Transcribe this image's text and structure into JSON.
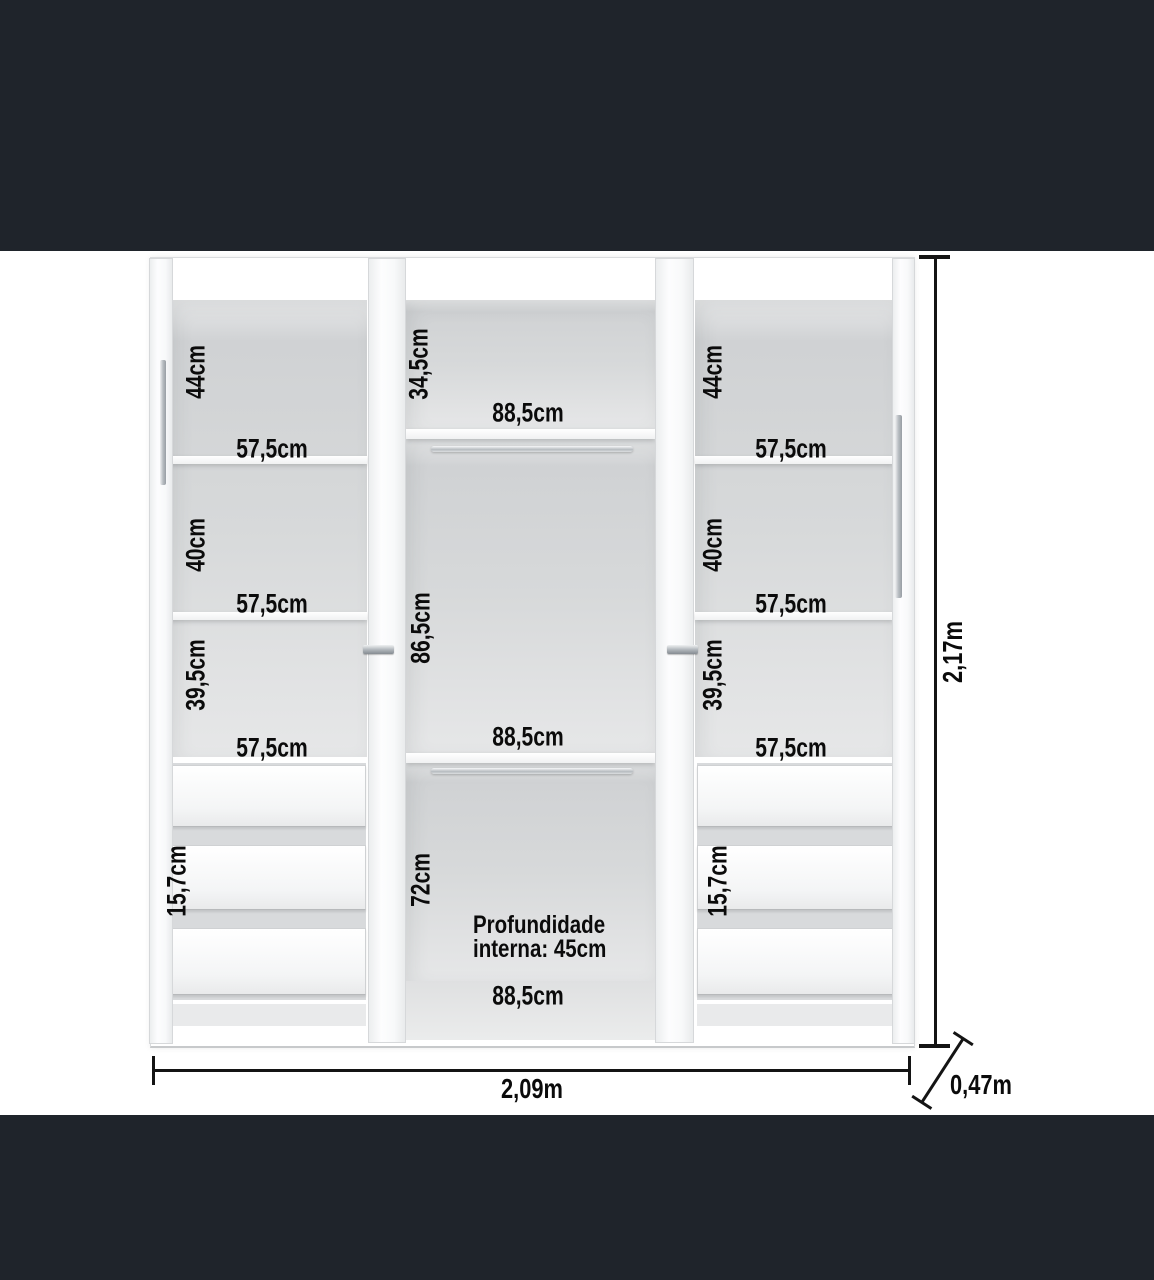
{
  "diagram_type": "wardrobe-internal-dimensions",
  "left": {
    "compartments": [
      {
        "h": "44cm",
        "w": "57,5cm"
      },
      {
        "h": "40cm",
        "w": "57,5cm"
      },
      {
        "h": "39,5cm",
        "w": "57,5cm"
      }
    ],
    "drawer_h": "15,7cm",
    "drawer_count": 3
  },
  "middle": {
    "sections": [
      {
        "h": "34,5cm",
        "w": "88,5cm"
      },
      {
        "h": "86,5cm",
        "w": "88,5cm"
      },
      {
        "h": "72cm",
        "w": "88,5cm"
      }
    ],
    "note": {
      "line1": "Profundidade",
      "line2": "interna: 45cm"
    }
  },
  "right": {
    "compartments": [
      {
        "h": "44cm",
        "w": "57,5cm"
      },
      {
        "h": "40cm",
        "w": "57,5cm"
      },
      {
        "h": "39,5cm",
        "w": "57,5cm"
      }
    ],
    "drawer_h": "15,7cm",
    "drawer_count": 3
  },
  "overall": {
    "width": "2,09m",
    "height": "2,17m",
    "depth": "0,47m"
  },
  "colors": {
    "band": "#1f242b",
    "canvas": "#ffffff",
    "interior_gray": "#d7d9da",
    "panel_white": "#fdfdfe",
    "text": "#0b0b0b",
    "dimension_line": "#141414",
    "chrome_handle": "#aeb3b8"
  }
}
